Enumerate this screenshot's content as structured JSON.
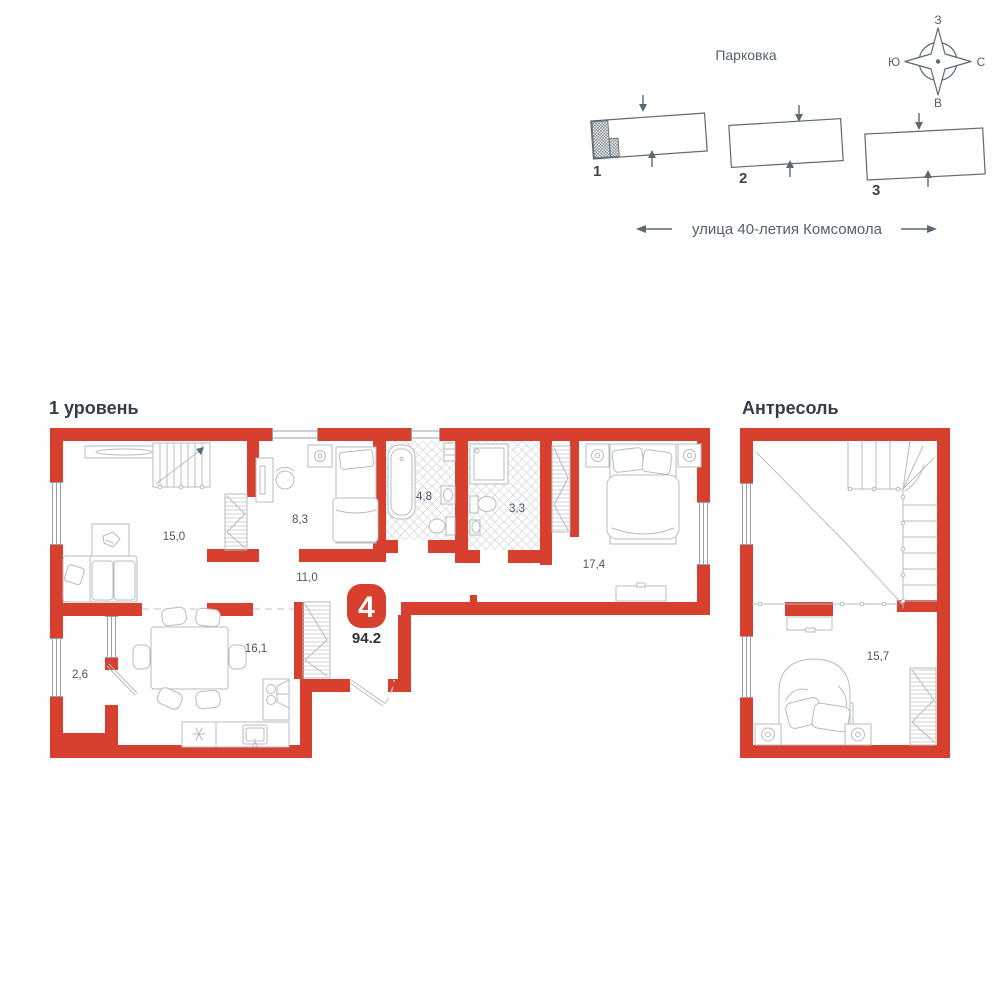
{
  "colors": {
    "wall_red": "#D7402E",
    "text_dark": "#333E48",
    "text_medium": "#53616C",
    "furniture_line": "#B6BCC2"
  },
  "site_plan": {
    "parking_label": "Парковка",
    "street_label": "улица 40-летия Комсомола",
    "compass": {
      "top": "З",
      "left": "Ю",
      "right": "С",
      "bottom": "В"
    },
    "buildings": [
      {
        "number": "1",
        "highlighted": true
      },
      {
        "number": "2",
        "highlighted": false
      },
      {
        "number": "3",
        "highlighted": false
      }
    ]
  },
  "floor_plan": {
    "level1": {
      "title": "1 уровень",
      "rooms": [
        {
          "name": "living-room",
          "area": "15,0"
        },
        {
          "name": "bedroom-2",
          "area": "8,3"
        },
        {
          "name": "bathroom",
          "area": "4,8"
        },
        {
          "name": "shower-room",
          "area": "3,3"
        },
        {
          "name": "bedroom-1",
          "area": "17,4"
        },
        {
          "name": "hallway",
          "area": "11,0"
        },
        {
          "name": "kitchen-dining",
          "area": "16,1"
        },
        {
          "name": "balcony",
          "area": "2,6"
        }
      ]
    },
    "mezzanine": {
      "title": "Антресоль",
      "rooms": [
        {
          "name": "mezzanine-bedroom",
          "area": "15,7"
        }
      ]
    },
    "badge": {
      "rooms_count": "4",
      "total_area": "94.2"
    }
  }
}
